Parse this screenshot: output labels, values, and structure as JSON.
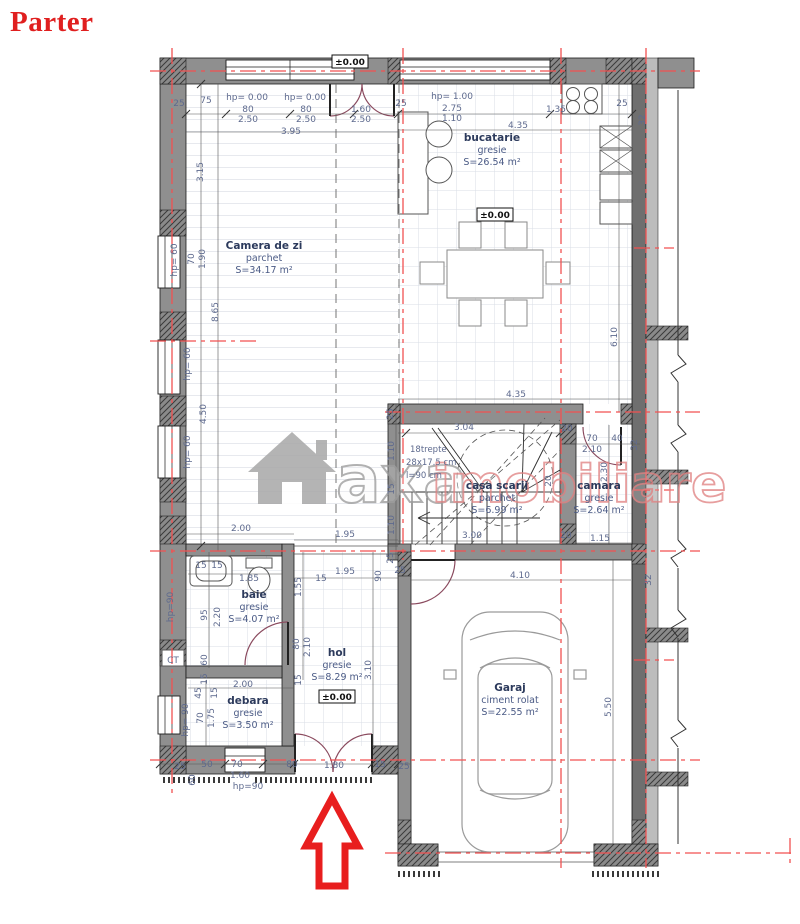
{
  "title": "Parter",
  "watermark": {
    "word1": "axa",
    "word2": "imobiliare"
  },
  "rooms": [
    {
      "name": "Camera de zi",
      "finish": "parchet",
      "area": "S=34.17 m²",
      "x": 264,
      "y": 249
    },
    {
      "name": "bucatarie",
      "finish": "gresie",
      "area": "S=26.54 m²",
      "x": 492,
      "y": 141
    },
    {
      "name": "casa scarii",
      "finish": "parchet",
      "area": "S=6.99 m²",
      "x": 497,
      "y": 489
    },
    {
      "name": "camara",
      "finish": "gresie",
      "area": "S=2.64 m²",
      "x": 599,
      "y": 489
    },
    {
      "name": "baie",
      "finish": "gresie",
      "area": "S=4.07 m²",
      "x": 254,
      "y": 598
    },
    {
      "name": "hol",
      "finish": "gresie",
      "area": "S=8.29 m²",
      "x": 337,
      "y": 656
    },
    {
      "name": "debara",
      "finish": "gresie",
      "area": "S=3.50 m²",
      "x": 248,
      "y": 704
    },
    {
      "name": "Garaj",
      "finish": "ciment rolat",
      "area": "S=22.55 m²",
      "x": 510,
      "y": 691
    }
  ],
  "levels": [
    {
      "text": "±0.00",
      "x": 350,
      "y": 65
    },
    {
      "text": "±0.00",
      "x": 495,
      "y": 218
    },
    {
      "text": "±0.00",
      "x": 337,
      "y": 700
    }
  ],
  "stair_notes": [
    {
      "t": "18trepte",
      "x": 410,
      "y": 452
    },
    {
      "t": "28x17.5 cm",
      "x": 406,
      "y": 465
    },
    {
      "t": "l=90 cm",
      "x": 406,
      "y": 478
    }
  ],
  "dims": [
    {
      "t": "25",
      "x": 179,
      "y": 106
    },
    {
      "t": "75",
      "x": 206,
      "y": 103
    },
    {
      "t": "hp= 0.00",
      "x": 247,
      "y": 100
    },
    {
      "t": "hp= 0.00",
      "x": 305,
      "y": 100
    },
    {
      "t": "80",
      "x": 248,
      "y": 112
    },
    {
      "t": "2.50",
      "x": 248,
      "y": 122
    },
    {
      "t": "80",
      "x": 306,
      "y": 112
    },
    {
      "t": "2.50",
      "x": 306,
      "y": 122
    },
    {
      "t": "1.60",
      "x": 361,
      "y": 112
    },
    {
      "t": "2.50",
      "x": 361,
      "y": 122
    },
    {
      "t": "3.95",
      "x": 291,
      "y": 134
    },
    {
      "t": "25",
      "x": 401,
      "y": 106
    },
    {
      "t": "hp= 1.00",
      "x": 452,
      "y": 99
    },
    {
      "t": "2.75",
      "x": 452,
      "y": 111
    },
    {
      "t": "1.10",
      "x": 452,
      "y": 121
    },
    {
      "t": "1.35",
      "x": 556,
      "y": 112
    },
    {
      "t": "25",
      "x": 622,
      "y": 106
    },
    {
      "t": "4.35",
      "x": 518,
      "y": 128
    },
    {
      "t": "32",
      "x": 645,
      "y": 120,
      "r": 1
    },
    {
      "t": "3.15",
      "x": 203,
      "y": 172,
      "r": 1
    },
    {
      "t": "hp= 60",
      "x": 177,
      "y": 260,
      "r": 1
    },
    {
      "t": "70",
      "x": 194,
      "y": 259,
      "r": 1
    },
    {
      "t": "1.90",
      "x": 205,
      "y": 259,
      "r": 1
    },
    {
      "t": "8.65",
      "x": 218,
      "y": 312,
      "r": 1
    },
    {
      "t": "hp= 60",
      "x": 190,
      "y": 364,
      "r": 1
    },
    {
      "t": "4.50",
      "x": 206,
      "y": 414,
      "r": 1
    },
    {
      "t": "hp= 60",
      "x": 190,
      "y": 452,
      "r": 1
    },
    {
      "t": "2.00",
      "x": 241,
      "y": 531
    },
    {
      "t": "1.95",
      "x": 345,
      "y": 537
    },
    {
      "t": "1.95",
      "x": 345,
      "y": 574
    },
    {
      "t": "90",
      "x": 381,
      "y": 576,
      "r": 1
    },
    {
      "t": "25",
      "x": 400,
      "y": 573
    },
    {
      "t": "4.35",
      "x": 516,
      "y": 397
    },
    {
      "t": "3.04",
      "x": 464,
      "y": 430
    },
    {
      "t": "20",
      "x": 567,
      "y": 431
    },
    {
      "t": "1.10",
      "x": 394,
      "y": 451,
      "r": 1
    },
    {
      "t": "15",
      "x": 394,
      "y": 489,
      "r": 1
    },
    {
      "t": "1.10",
      "x": 394,
      "y": 525,
      "r": 1
    },
    {
      "t": "25",
      "x": 393,
      "y": 414,
      "r": 1
    },
    {
      "t": "25",
      "x": 393,
      "y": 558,
      "r": 1
    },
    {
      "t": "3.00",
      "x": 472,
      "y": 538
    },
    {
      "t": "20",
      "x": 566,
      "y": 538
    },
    {
      "t": "20",
      "x": 551,
      "y": 481,
      "r": 1
    },
    {
      "t": "70",
      "x": 592,
      "y": 441
    },
    {
      "t": "2.10",
      "x": 592,
      "y": 452
    },
    {
      "t": "40",
      "x": 617,
      "y": 441
    },
    {
      "t": "32",
      "x": 637,
      "y": 445,
      "r": 1
    },
    {
      "t": "2.30",
      "x": 607,
      "y": 472,
      "r": 1
    },
    {
      "t": "1.15",
      "x": 600,
      "y": 541
    },
    {
      "t": "6.10",
      "x": 617,
      "y": 337,
      "r": 1
    },
    {
      "t": "4.10",
      "x": 520,
      "y": 578
    },
    {
      "t": "5.50",
      "x": 611,
      "y": 707,
      "r": 1
    },
    {
      "t": "32",
      "x": 651,
      "y": 580,
      "r": 1
    },
    {
      "t": "15",
      "x": 201,
      "y": 568
    },
    {
      "t": "15",
      "x": 217,
      "y": 568
    },
    {
      "t": "1.85",
      "x": 249,
      "y": 581
    },
    {
      "t": "15",
      "x": 321,
      "y": 581
    },
    {
      "t": "hp=90",
      "x": 173,
      "y": 607,
      "r": 1
    },
    {
      "t": "95",
      "x": 207,
      "y": 615,
      "r": 1
    },
    {
      "t": "2.20",
      "x": 220,
      "y": 617,
      "r": 1
    },
    {
      "t": "60",
      "x": 207,
      "y": 660,
      "r": 1
    },
    {
      "t": "15",
      "x": 207,
      "y": 679,
      "r": 1
    },
    {
      "t": "1.55",
      "x": 301,
      "y": 587,
      "r": 1
    },
    {
      "t": "80",
      "x": 299,
      "y": 644,
      "r": 1
    },
    {
      "t": "2.10",
      "x": 310,
      "y": 647,
      "r": 1
    },
    {
      "t": "15",
      "x": 301,
      "y": 680,
      "r": 1
    },
    {
      "t": "3.10",
      "x": 371,
      "y": 670,
      "r": 1
    },
    {
      "t": "2.00",
      "x": 243,
      "y": 687
    },
    {
      "t": "45",
      "x": 201,
      "y": 693,
      "r": 1
    },
    {
      "t": "15",
      "x": 217,
      "y": 693,
      "r": 1
    },
    {
      "t": "hp= 90",
      "x": 188,
      "y": 720,
      "r": 1
    },
    {
      "t": "70",
      "x": 203,
      "y": 718,
      "r": 1
    },
    {
      "t": "1.75",
      "x": 214,
      "y": 718,
      "r": 1
    },
    {
      "t": "25",
      "x": 180,
      "y": 769
    },
    {
      "t": "50",
      "x": 207,
      "y": 767
    },
    {
      "t": "60",
      "x": 195,
      "y": 780,
      "r": 1
    },
    {
      "t": "70",
      "x": 237,
      "y": 767
    },
    {
      "t": "1.60",
      "x": 240,
      "y": 778
    },
    {
      "t": "hp=90",
      "x": 248,
      "y": 789
    },
    {
      "t": "80",
      "x": 292,
      "y": 767
    },
    {
      "t": "1.80",
      "x": 334,
      "y": 768
    },
    {
      "t": "15",
      "x": 380,
      "y": 767
    },
    {
      "t": "25",
      "x": 404,
      "y": 769
    },
    {
      "t": "CT",
      "x": 173,
      "y": 663
    }
  ]
}
